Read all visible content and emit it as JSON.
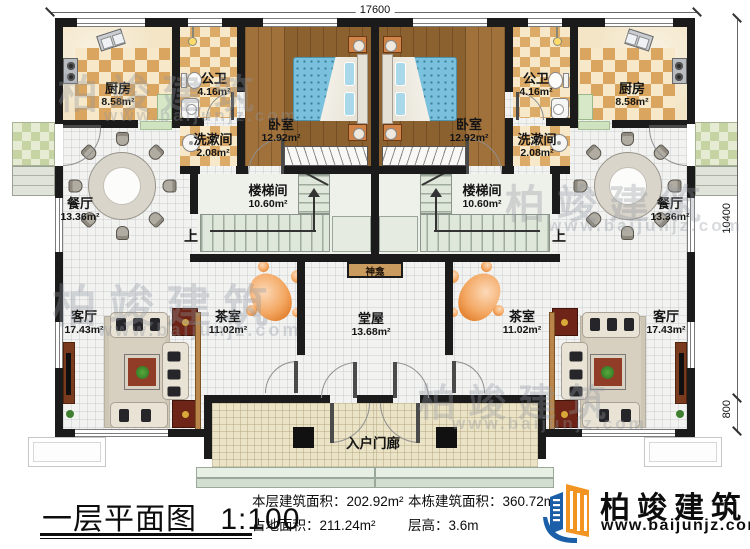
{
  "plan": {
    "dimensions": {
      "width": "17600",
      "depth": "10400",
      "porch_depth": "800"
    },
    "rooms": {
      "kitchen": {
        "name": "厨房",
        "area": "8.58m²"
      },
      "bath": {
        "name": "公卫",
        "area": "4.16m²"
      },
      "wash": {
        "name": "洗漱间",
        "area": "2.08m²"
      },
      "bedroom": {
        "name": "卧室",
        "area": "12.92m²"
      },
      "dining": {
        "name": "餐厅",
        "area": "13.36m²"
      },
      "stair": {
        "name": "楼梯间",
        "area": "10.60m²"
      },
      "living": {
        "name": "客厅",
        "area": "17.43m²"
      },
      "tea": {
        "name": "茶室",
        "area": "11.02m²"
      },
      "hall": {
        "name": "堂屋",
        "area": "13.68m²"
      },
      "shrine": {
        "name": "神龛"
      },
      "porch": {
        "name": "入户门廊"
      },
      "stair_up": {
        "label": "上"
      }
    }
  },
  "title_block": {
    "plan_title": "一层平面图",
    "scale": "1:100",
    "stats": [
      {
        "label": "本层建筑面积：",
        "value": "202.92m²"
      },
      {
        "label": "占地面积：",
        "value": "211.24m²"
      },
      {
        "label": "本栋建筑面积：",
        "value": "360.72m²"
      },
      {
        "label": "层高：",
        "value": "3.6m"
      }
    ],
    "brand": {
      "name": "柏竣建筑",
      "website": "www.baijunjz.com"
    }
  },
  "watermark": {
    "text": "柏竣建筑",
    "url": "www.baijunjz.com"
  }
}
